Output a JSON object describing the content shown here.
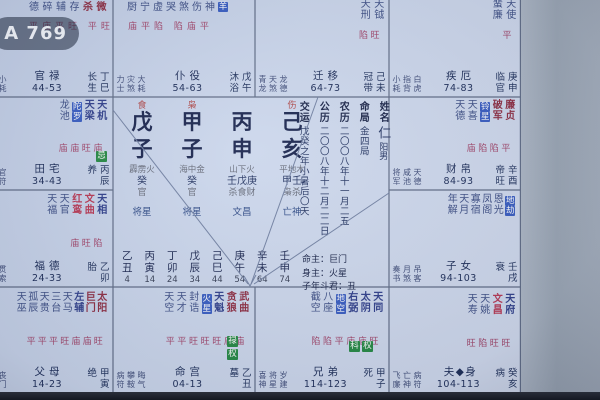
{
  "overlay": {
    "badge": "A 769"
  },
  "palaces": {
    "si": {
      "frag": [
        {
          "t": "德",
          "c": "mi"
        },
        {
          "t": "碎",
          "c": "mi"
        },
        {
          "t": "辅",
          "c": "mi"
        },
        {
          "t": "存",
          "c": "mi"
        },
        {
          "t": "杀",
          "c": "ma"
        },
        {
          "t": "微",
          "c": "ma"
        }
      ],
      "bright": "平庙平旺 平旺",
      "trio": [
        "小耗"
      ],
      "palace": "官禄",
      "range": "44-53",
      "stage": "长生",
      "ganzhi": "丁巳"
    },
    "wu": {
      "frag": [
        {
          "t": "厨",
          "c": "mi"
        },
        {
          "t": "宁",
          "c": "mi"
        },
        {
          "t": "虚",
          "c": "mi"
        },
        {
          "t": "哭",
          "c": "mi"
        },
        {
          "t": "煞",
          "c": "mi"
        },
        {
          "t": "伤",
          "c": "mi"
        },
        {
          "t": "神",
          "c": "mi"
        },
        {
          "t": "羊",
          "c": "sha"
        }
      ],
      "bright": "庙平陷 陷庙平",
      "trio": [
        "力士",
        "灾煞",
        "大耗"
      ],
      "palace": "仆役",
      "range": "54-63",
      "stage": "沐浴",
      "ganzhi": "戊午"
    },
    "wei": {
      "stars": [
        {
          "n": "天刑",
          "c": "mi"
        },
        {
          "n": "天钺",
          "c": "mi"
        }
      ],
      "bright": "陷旺",
      "trio": [
        "青龙",
        "天煞",
        "龙德"
      ],
      "palace": "迁移",
      "range": "64-73",
      "stage": "冠带",
      "ganzhi": "己未"
    },
    "shen": {
      "stars": [
        {
          "n": "蜚廉",
          "c": "mi"
        },
        {
          "n": "天使",
          "c": "mi"
        }
      ],
      "bright": "平",
      "trio": [
        "小耗",
        "指背",
        "白虎"
      ],
      "palace": "疾厄",
      "range": "74-83",
      "stage": "临官",
      "ganzhi": "庚申"
    },
    "chen": {
      "stars": [
        {
          "n": "龙池",
          "c": "mi"
        },
        {
          "n": "陀罗",
          "c": "sha"
        },
        {
          "n": "天梁",
          "c": "mb"
        },
        {
          "n": "天机",
          "c": "mb"
        }
      ],
      "bright": "庙庙旺庙",
      "chips": [
        {
          "t": "忌",
          "c": "green"
        }
      ],
      "trio": [
        "官符"
      ],
      "palace": "田宅",
      "range": "34-43",
      "stage": "养",
      "ganzhi": "丙辰"
    },
    "mao": {
      "stars": [
        {
          "n": "天福",
          "c": "mi"
        },
        {
          "n": "天官",
          "c": "mi"
        },
        {
          "n": "红鸾",
          "c": "rd"
        },
        {
          "n": "文曲",
          "c": "rd"
        },
        {
          "n": "天相",
          "c": "mb"
        }
      ],
      "bright": "庙旺陷",
      "trio": [
        "贯索"
      ],
      "palace": "福德",
      "range": "24-33",
      "stage": "胎",
      "ganzhi": "乙卯"
    },
    "yin": {
      "stars": [
        {
          "n": "天巫",
          "c": "mi"
        },
        {
          "n": "孤辰",
          "c": "mi"
        },
        {
          "n": "天贵",
          "c": "mi"
        },
        {
          "n": "三台",
          "c": "mi"
        },
        {
          "n": "天马",
          "c": "mi"
        },
        {
          "n": "左辅",
          "c": "mb"
        },
        {
          "n": "巨门",
          "c": "ma"
        },
        {
          "n": "太阳",
          "c": "ma"
        }
      ],
      "bright": "平平平旺庙庙旺",
      "trio": [
        "丧门"
      ],
      "palace": "父母",
      "range": "14-23",
      "stage": "绝",
      "ganzhi": "甲寅"
    },
    "you": {
      "stars": [
        {
          "n": "天德",
          "c": "mi"
        },
        {
          "n": "天喜",
          "c": "mi"
        },
        {
          "n": "铃星",
          "c": "sha"
        },
        {
          "n": "破军",
          "c": "ma"
        },
        {
          "n": "廉贞",
          "c": "ma"
        }
      ],
      "bright": "庙陷陷平",
      "trio": [
        "将军",
        "咸池",
        "天德"
      ],
      "palace": "财帛",
      "range": "84-93",
      "stage": "帝旺",
      "ganzhi": "辛酉"
    },
    "xu": {
      "stars": [
        {
          "n": "年解",
          "c": "mi"
        },
        {
          "n": "天月",
          "c": "mi"
        },
        {
          "n": "寡宿",
          "c": "mi"
        },
        {
          "n": "凤阁",
          "c": "mi"
        },
        {
          "n": "恩光",
          "c": "mi"
        },
        {
          "n": "地劫",
          "c": "sha"
        }
      ],
      "bright": "",
      "trio": [
        "奏书",
        "月煞",
        "吊客"
      ],
      "palace": "子女",
      "range": "94-103",
      "stage": "衰",
      "ganzhi": "壬戌"
    },
    "chou": {
      "stars": [
        {
          "n": "天空",
          "c": "mi"
        },
        {
          "n": "天才",
          "c": "mi"
        },
        {
          "n": "封诰",
          "c": "mi"
        },
        {
          "n": "火星",
          "c": "sha"
        },
        {
          "n": "天魁",
          "c": "mb"
        },
        {
          "n": "贪狼",
          "c": "ma"
        },
        {
          "n": "武曲",
          "c": "ma"
        }
      ],
      "bright": "平平旺旺旺庙庙",
      "chips": [
        {
          "t": "禄",
          "c": "green"
        },
        {
          "t": "权",
          "c": "green"
        }
      ],
      "trio": [
        "病符",
        "攀鞍",
        "晦气"
      ],
      "palace": "命宫",
      "range": "04-13",
      "stage": "墓",
      "ganzhi": "乙丑"
    },
    "zi": {
      "stars": [
        {
          "n": "截空",
          "c": "mi"
        },
        {
          "n": "八座",
          "c": "mi"
        },
        {
          "n": "地空",
          "c": "sha"
        },
        {
          "n": "右弼",
          "c": "mb"
        },
        {
          "n": "太阴",
          "c": "mb"
        },
        {
          "n": "天同",
          "c": "mb"
        }
      ],
      "bright": "陷陷平庙庙旺",
      "chips": [
        {
          "t": "科",
          "c": "green"
        },
        {
          "t": "权",
          "c": "green"
        }
      ],
      "trio": [
        "喜神",
        "将星",
        "岁建"
      ],
      "palace": "兄弟",
      "range": "114-123",
      "stage": "死",
      "ganzhi": "甲子"
    },
    "hai": {
      "stars": [
        {
          "n": "天寿",
          "c": "mi"
        },
        {
          "n": "天姚",
          "c": "mi"
        },
        {
          "n": "文昌",
          "c": "rd"
        },
        {
          "n": "天府",
          "c": "mb"
        }
      ],
      "bright": "旺陷旺旺",
      "trio": [
        "飞廉",
        "亡神",
        "病符"
      ],
      "palace": "夫◆身",
      "range": "104-113",
      "stage": "病",
      "ganzhi": "癸亥"
    }
  },
  "center": {
    "ten_gods": [
      "食",
      "枭",
      "",
      "伤"
    ],
    "stems": [
      "戊",
      "甲",
      "丙",
      "己"
    ],
    "branches": [
      "子",
      "子",
      "申",
      "亥"
    ],
    "nayin": [
      "霹雳火",
      "海中金",
      "山下火",
      "平地木"
    ],
    "hidden": [
      {
        "s": "癸",
        "g": "官"
      },
      {
        "s": "癸",
        "g": "官"
      },
      {
        "s": "壬戊庚",
        "g": "杀食财"
      },
      {
        "s": "甲壬",
        "g": "枭杀"
      }
    ],
    "shensha": [
      "将星",
      "将星",
      "文昌",
      "亡神"
    ],
    "info": [
      {
        "label": "交运",
        "value": "戊癸之年小暑后〇天"
      },
      {
        "label": "公历",
        "value": "二〇〇八年十二月二二日"
      },
      {
        "label": "农历",
        "value": "二〇〇八年十一月二五"
      },
      {
        "label": "命局",
        "value": "金四局"
      },
      {
        "label": "姓名",
        "value": "仁",
        "value2": "阳男"
      }
    ],
    "masters": {
      "ming": "命主：巨门",
      "shen": "身主：火星",
      "dou": "子年斗君：丑"
    },
    "dayun": [
      {
        "gz": "乙丑",
        "age": "4"
      },
      {
        "gz": "丙寅",
        "age": "14"
      },
      {
        "gz": "丁卯",
        "age": "24"
      },
      {
        "gz": "戊辰",
        "age": "34"
      },
      {
        "gz": "己巳",
        "age": "44"
      },
      {
        "gz": "庚午",
        "age": "54"
      },
      {
        "gz": "辛未",
        "age": "64"
      },
      {
        "gz": "壬申",
        "age": "74"
      }
    ]
  }
}
